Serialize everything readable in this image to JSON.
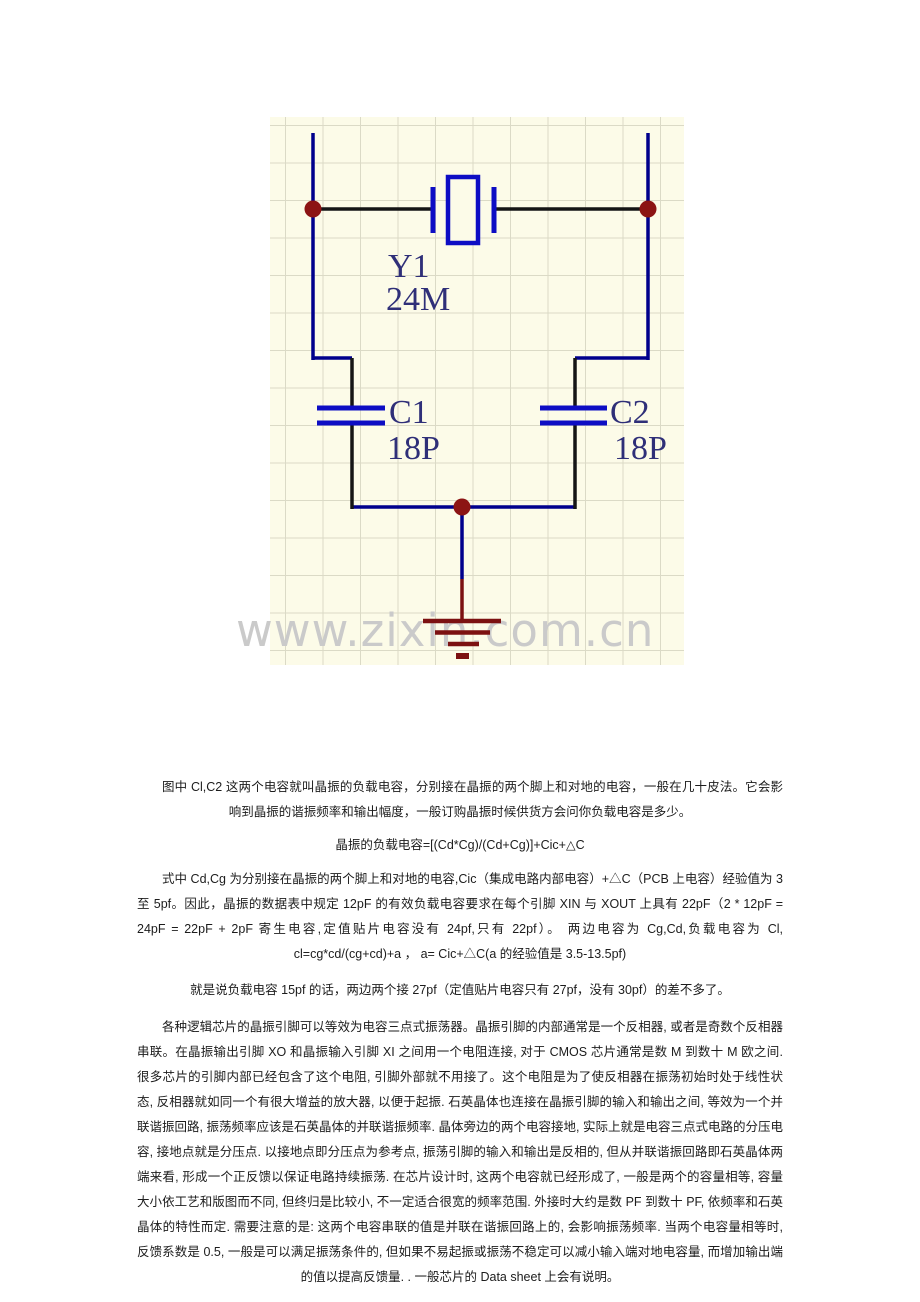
{
  "schematic": {
    "background_color": "#fcfbe8",
    "grid_color": "#dbdac6",
    "wire_color": "#00008c",
    "black_wire_color": "#151515",
    "component_color": "#0d0dc4",
    "junction_color": "#8c1414",
    "ground_color": "#7c1111",
    "label_color": "#2f2f78",
    "crystal": {
      "designator": "Y1",
      "value": "24M"
    },
    "cap_left": {
      "designator": "C1",
      "value": "18P"
    },
    "cap_right": {
      "designator": "C2",
      "value": "18P"
    },
    "watermark": {
      "text": "www.zixin.com.cn",
      "color": "#cacaca"
    }
  },
  "document": {
    "paragraph1": "图中 Cl,C2 这两个电容就叫晶振的负载电容，分别接在晶振的两个脚上和对地的电容，一般在几十皮法。它会影响到晶振的谐振频率和输出幅度，一般订购晶振时候供货方会问你负载电容是多少。",
    "formula": "晶振的负载电容=[(Cd*Cg)/(Cd+Cg)]+Cic+△C",
    "paragraph2": "式中 Cd,Cg 为分别接在晶振的两个脚上和对地的电容,Cic（集成电路内部电容）+△C（PCB 上电容）经验值为 3 至 5pf。因此，晶振的数据表中规定 12pF 的有效负载电容要求在每个引脚 XIN 与 XOUT 上具有 22pF（2 * 12pF = 24pF = 22pF + 2pF 寄生电容,定值贴片电容没有 24pf,只有 22pf）。 两边电容为 Cg,Cd,负载电容为 Cl,  cl=cg*cd/(cg+cd)+a ， a= Cic+△C(a 的经验值是 3.5-13.5pf)",
    "paragraph3": "就是说负载电容 15pf 的话，两边两个接 27pf（定值贴片电容只有 27pf，没有 30pf）的差不多了。",
    "paragraph4": "各种逻辑芯片的晶振引脚可以等效为电容三点式振荡器。晶振引脚的内部通常是一个反相器, 或者是奇数个反相器串联。在晶振输出引脚 XO 和晶振输入引脚 XI 之间用一个电阻连接, 对于 CMOS 芯片通常是数 M 到数十 M 欧之间. 很多芯片的引脚内部已经包含了这个电阻, 引脚外部就不用接了。这个电阻是为了使反相器在振荡初始时处于线性状态, 反相器就如同一个有很大增益的放大器, 以便于起振. 石英晶体也连接在晶振引脚的输入和输出之间, 等效为一个并联谐振回路, 振荡频率应该是石英晶体的并联谐振频率. 晶体旁边的两个电容接地, 实际上就是电容三点式电路的分压电容, 接地点就是分压点. 以接地点即分压点为参考点, 振荡引脚的输入和输出是反相的, 但从并联谐振回路即石英晶体两端来看, 形成一个正反馈以保证电路持续振荡. 在芯片设计时, 这两个电容就已经形成了, 一般是两个的容量相等, 容量大小依工艺和版图而不同, 但终归是比较小, 不一定适合很宽的频率范围. 外接时大约是数 PF 到数十 PF, 依频率和石英晶体的特性而定. 需要注意的是: 这两个电容串联的值是并联在谐振回路上的, 会影响振荡频率. 当两个电容量相等时, 反馈系数是 0.5, 一般是可以满足振荡条件的, 但如果不易起振或振荡不稳定可以减小输入端对地电容量, 而增加输出端的值以提高反馈量. . 一般芯片的 Data sheet 上会有说明。"
  }
}
